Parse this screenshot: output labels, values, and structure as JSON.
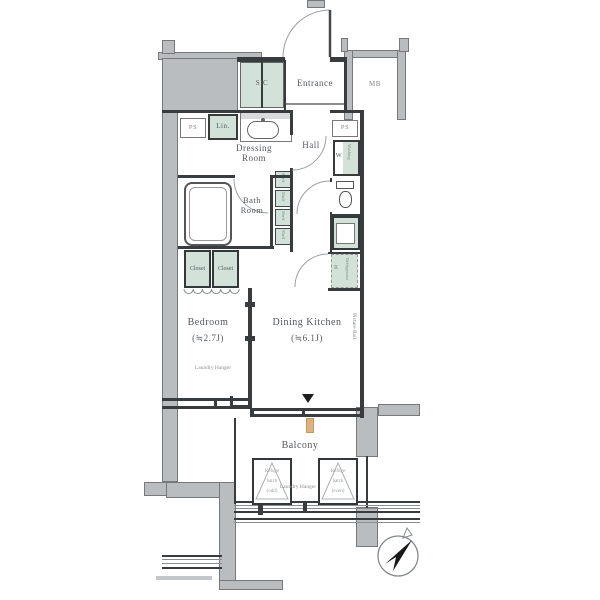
{
  "title": "Apartment floor plan",
  "colors": {
    "structure_gray": "#b9bdbf",
    "accent_green": "#d3e2d8",
    "wall": "#383c3e",
    "downspout_tan": "#dcb284"
  },
  "labels": {
    "sic": "SIC",
    "entrance": "Entrance",
    "mb": "MB",
    "ps": "PS",
    "lin": "Lin.",
    "dressing_room": "Dressing Room",
    "hall": "Hall",
    "w": "W",
    "washing_vertical": "Washing",
    "bath_room": "Bath Room",
    "shelf": "Shelf",
    "closet": "Closet",
    "r": "R",
    "refrigerator_vertical": "Refrigerator",
    "bedroom": "Bedroom",
    "bedroom_size": "(≒2.7J)",
    "dining_kitchen": "Dining Kitchen",
    "dining_kitchen_size": "(≒6.1J)",
    "laundry_hanger": "Laundry Hanger",
    "picture_rail": "Picture Rail",
    "balcony": "Balcony",
    "refuge_hatch_odd": [
      "Refuge",
      "hatch",
      "(odd)"
    ],
    "refuge_hatch_even": [
      "Refuge",
      "hatch",
      "(even)"
    ]
  }
}
